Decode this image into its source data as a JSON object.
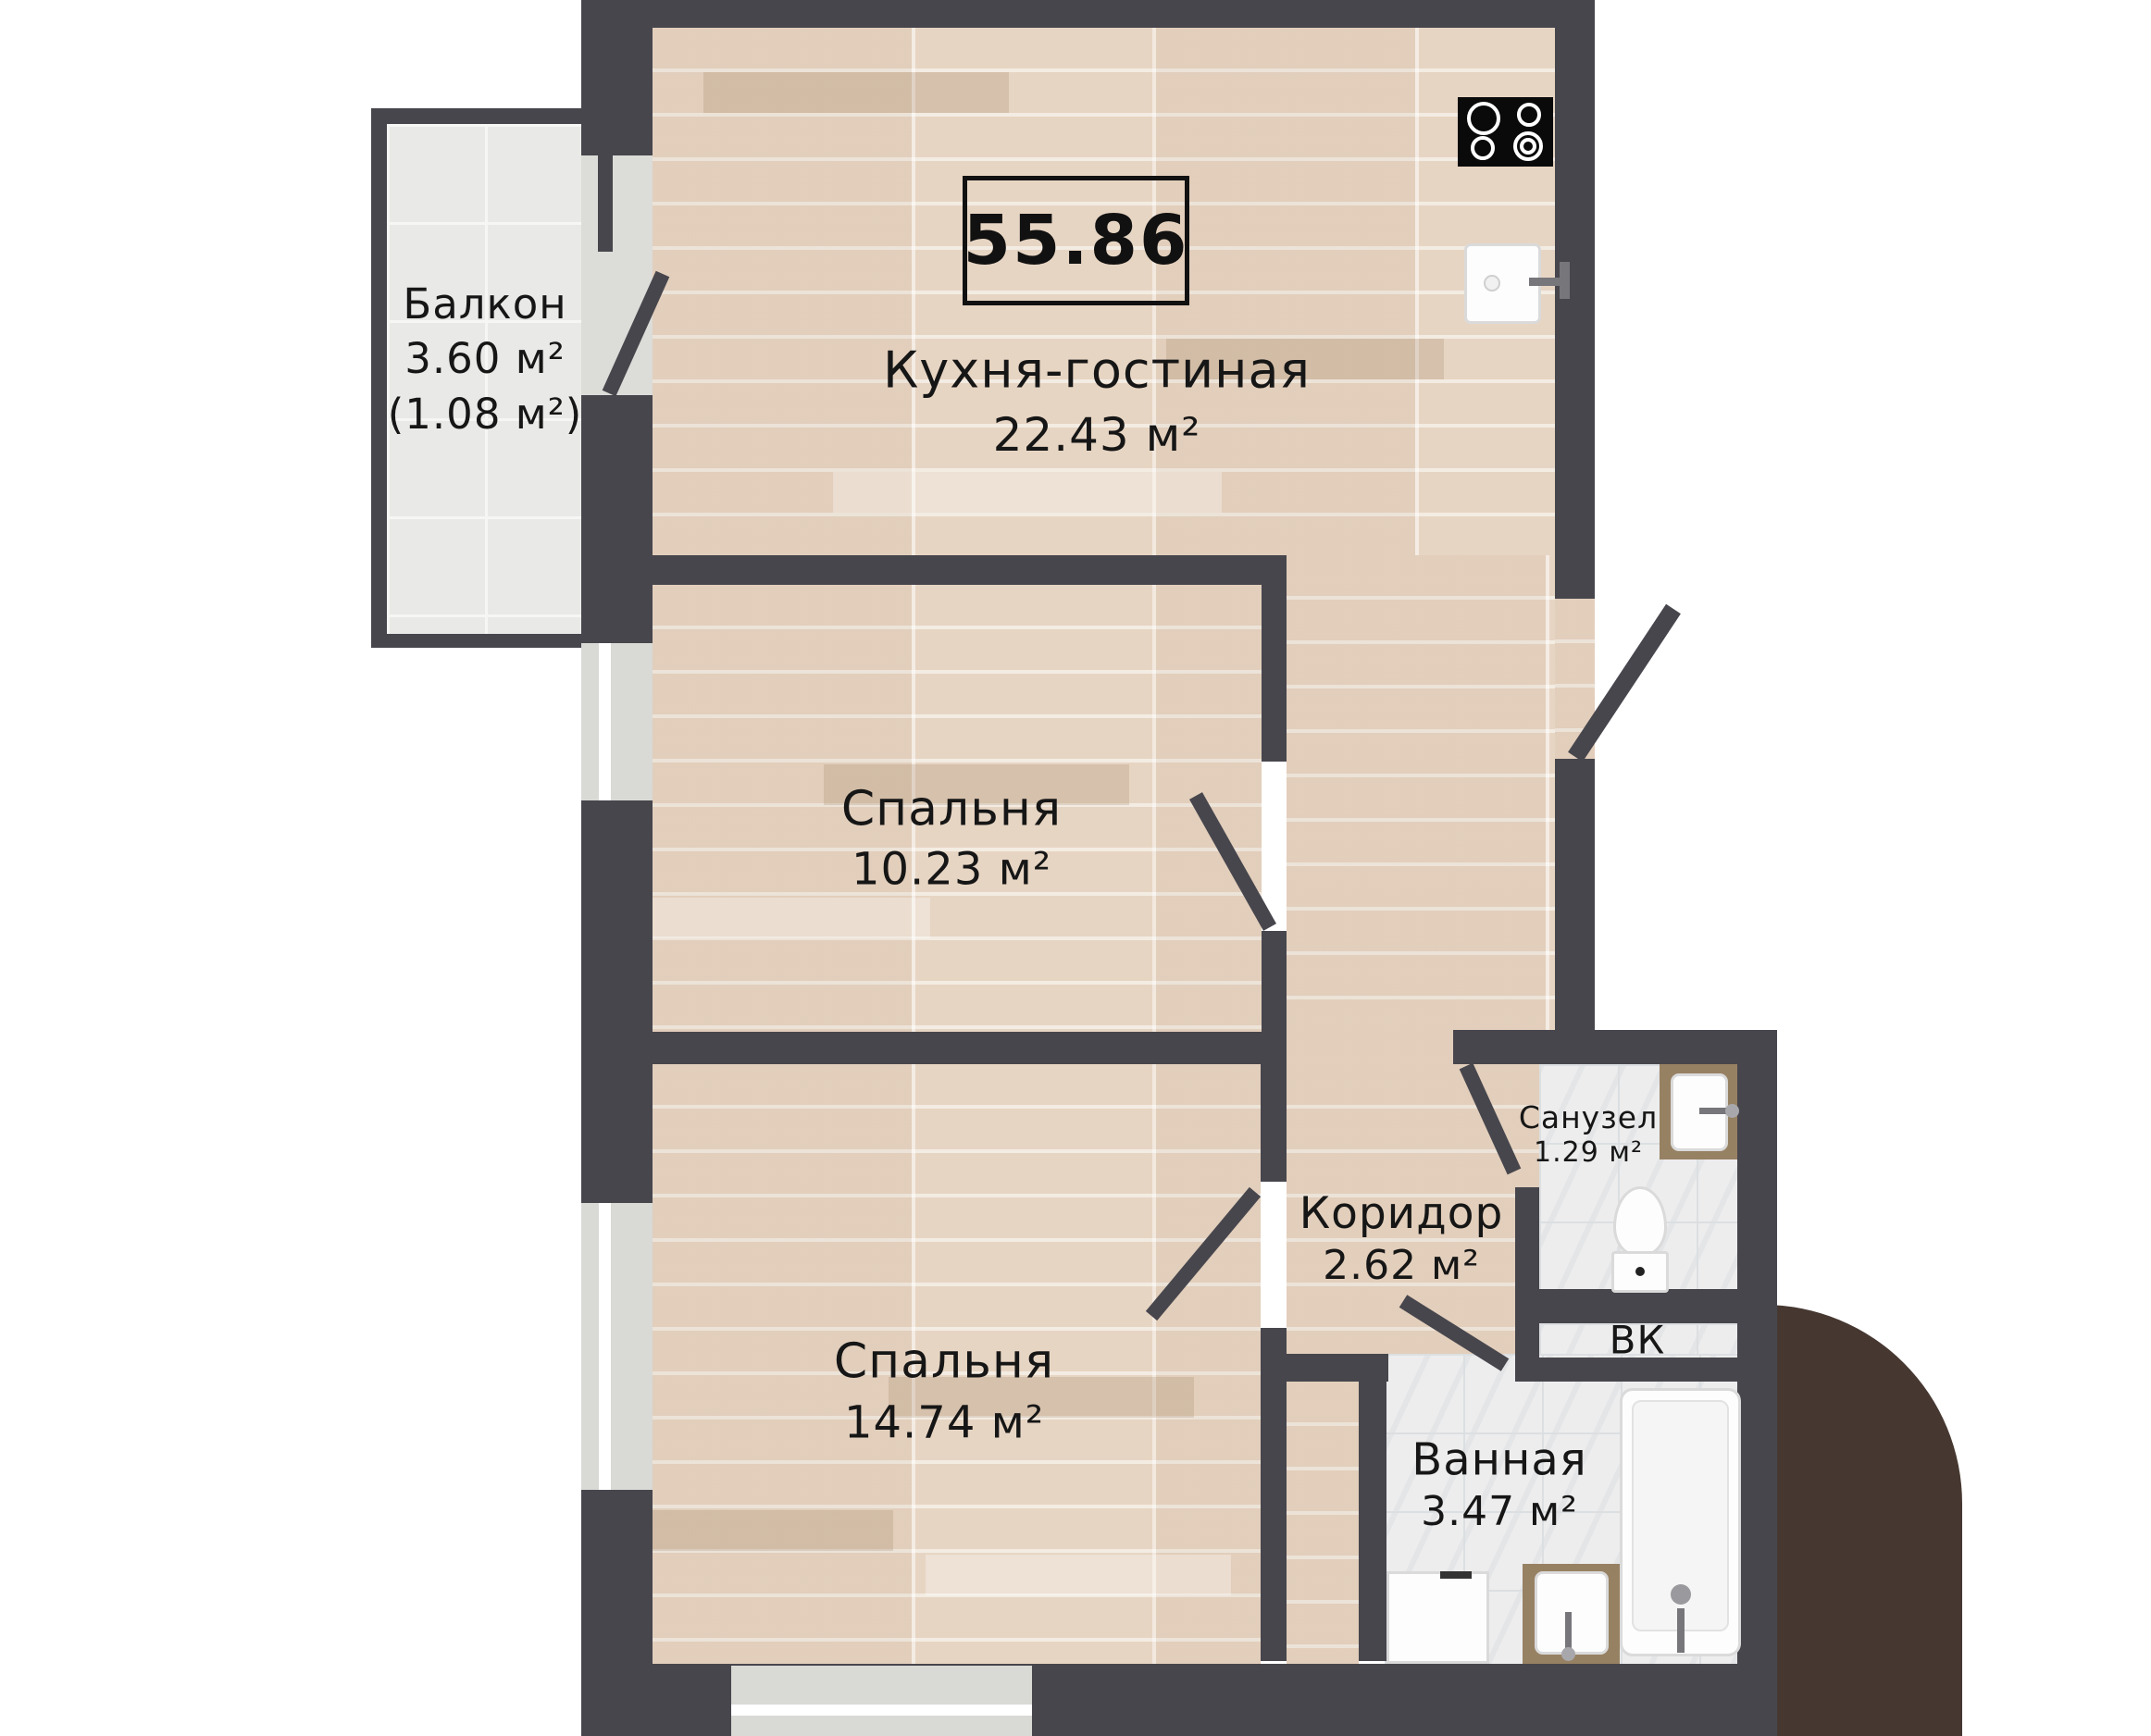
{
  "total_area": "55.86",
  "rooms": {
    "kitchen": {
      "name": "Кухня-гостиная",
      "area": "22.43 м²"
    },
    "balcony": {
      "name": "Балкон",
      "area": "3.60 м²",
      "area_extra": "(1.08 м²)"
    },
    "bedroom1": {
      "name": "Спальня",
      "area": "10.23 м²"
    },
    "bedroom2": {
      "name": "Спальня",
      "area": "14.74 м²"
    },
    "corridor": {
      "name": "Коридор",
      "area": "2.62 м²"
    },
    "wc": {
      "name": "Санузел",
      "area": "1.29 м²"
    },
    "duct": {
      "label": "ВК"
    },
    "bathroom": {
      "name": "Ванная",
      "area": "3.47 м²"
    }
  },
  "fixtures": [
    "stove",
    "kitchen-sink",
    "wc-sink",
    "toilet",
    "bathtub",
    "washing-machine",
    "bathroom-sink"
  ],
  "colors": {
    "wall": "#47464d",
    "wood_floor": "#e7d5c3",
    "balcony_tile": "#e9e9e7",
    "bath_tile": "#ededee",
    "window": "#d9d9d5",
    "corner_accent": "#463831",
    "stove": "#0a0a0a",
    "text": "#161616"
  }
}
